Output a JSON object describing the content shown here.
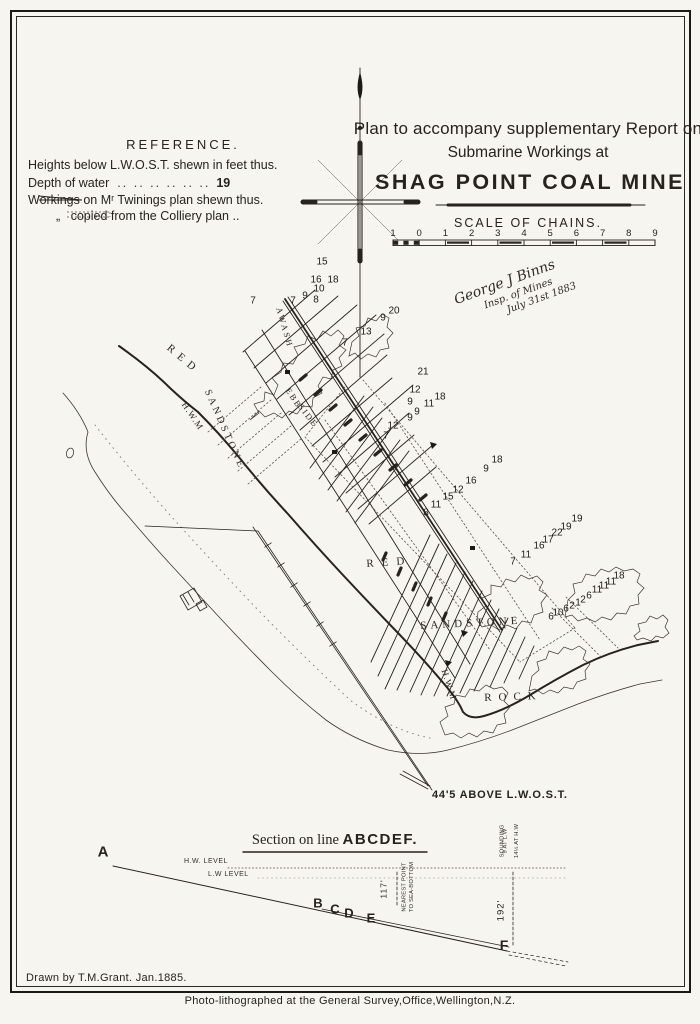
{
  "doc": {
    "title_line1": "Plan to accompany supplementary Report on",
    "title_line2": "Submarine Workings at",
    "title_line3": "SHAG POINT COAL MINE"
  },
  "reference": {
    "heading": "REFERENCE.",
    "rows": [
      {
        "prefix": "",
        "label": "Heights below L.W.O.S.T. shewn in feet thus.",
        "leader": "",
        "value": ""
      },
      {
        "prefix": "",
        "label": "Depth of water",
        "leader": "..  ..        ..   ..   ..   ..",
        "value": "19"
      },
      {
        "prefix": "",
        "label": "Workings on Mʳ Twinings plan shewn thus.",
        "leader": "",
        "value": ""
      },
      {
        "prefix": "„",
        "label": "copied from the Colliery plan ..",
        "leader": "",
        "value": ""
      }
    ]
  },
  "scale": {
    "heading": "SCALE OF CHAINS.",
    "ticks": [
      "1",
      "0",
      "1",
      "2",
      "3",
      "4",
      "5",
      "6",
      "7",
      "8",
      "9"
    ]
  },
  "signature": {
    "lines": [
      "George J Binns",
      "Insp. of Mines",
      "July 31st 1883"
    ]
  },
  "map": {
    "note_height": "44'5 ABOVE L.W.O.S.T.",
    "geology_labels": [
      {
        "t": "RED",
        "x": 172,
        "y": 342,
        "r": 40,
        "ls": 6,
        "fs": 11
      },
      {
        "t": "SANDSTONE",
        "x": 212,
        "y": 388,
        "r": 66,
        "ls": 3,
        "fs": 10
      },
      {
        "t": "H.W.M",
        "x": 188,
        "y": 400,
        "r": 56,
        "ls": 1,
        "fs": 9
      },
      {
        "t": "AWASH",
        "x": 284,
        "y": 306,
        "r": 74,
        "ls": 2.5,
        "fs": 8.5
      },
      {
        "t": "EBB",
        "x": 292,
        "y": 386,
        "r": 56,
        "ls": 2,
        "fs": 8.5
      },
      {
        "t": "SIDE",
        "x": 304,
        "y": 402,
        "r": 52,
        "ls": 2,
        "fs": 8.5
      },
      {
        "t": "RED",
        "x": 366,
        "y": 558,
        "r": -4,
        "ls": 8,
        "fs": 11
      },
      {
        "t": "SANDSTONE",
        "x": 420,
        "y": 620,
        "r": -3,
        "ls": 4,
        "fs": 11
      },
      {
        "t": "ROCK",
        "x": 484,
        "y": 692,
        "r": -2,
        "ls": 7,
        "fs": 11
      },
      {
        "t": "H.W.M",
        "x": 449,
        "y": 668,
        "r": 72,
        "ls": 1,
        "fs": 9
      }
    ],
    "depth_markers": [
      [
        322,
        262,
        "15"
      ],
      [
        316,
        280,
        "16"
      ],
      [
        333,
        280,
        "18"
      ],
      [
        319,
        289,
        "10"
      ],
      [
        305,
        296,
        "9"
      ],
      [
        316,
        300,
        "8"
      ],
      [
        253,
        301,
        "7"
      ],
      [
        293,
        301,
        "7"
      ],
      [
        383,
        318,
        "9"
      ],
      [
        394,
        311,
        "20"
      ],
      [
        366,
        332,
        "13"
      ],
      [
        345,
        343,
        "7"
      ],
      [
        423,
        372,
        "21"
      ],
      [
        415,
        390,
        "12"
      ],
      [
        410,
        402,
        "9"
      ],
      [
        429,
        404,
        "11"
      ],
      [
        440,
        397,
        "18"
      ],
      [
        417,
        412,
        "9"
      ],
      [
        410,
        418,
        "9"
      ],
      [
        393,
        426,
        "12"
      ],
      [
        386,
        436,
        "7"
      ],
      [
        497,
        460,
        "18"
      ],
      [
        486,
        469,
        "9"
      ],
      [
        471,
        481,
        "16"
      ],
      [
        458,
        490,
        "12"
      ],
      [
        448,
        497,
        "15"
      ],
      [
        436,
        505,
        "11"
      ],
      [
        426,
        513,
        "8"
      ],
      [
        577,
        519,
        "19"
      ],
      [
        566,
        527,
        "19"
      ],
      [
        557,
        533,
        "22"
      ],
      [
        548,
        540,
        "17"
      ],
      [
        539,
        546,
        "16"
      ],
      [
        526,
        555,
        "11"
      ],
      [
        513,
        562,
        "7"
      ],
      [
        619,
        576,
        "18"
      ],
      [
        611,
        582,
        "11"
      ],
      [
        604,
        586,
        "11"
      ],
      [
        597,
        590,
        "11"
      ],
      [
        589,
        596,
        "6"
      ],
      [
        583,
        600,
        "2"
      ],
      [
        578,
        603,
        "1"
      ],
      [
        572,
        606,
        "2"
      ],
      [
        566,
        609,
        "6"
      ],
      [
        558,
        613,
        "10"
      ],
      [
        551,
        617,
        "6"
      ]
    ]
  },
  "section": {
    "title_prefix": "Section on line ",
    "title_bold": "ABCDEF.",
    "level_hw": "H.W. LEVEL",
    "level_lw": "L.W LEVEL",
    "dim_nearest": "117'",
    "dim_nearest_note1": "NEAREST POINT",
    "dim_nearest_note2": "TO SEA-BOTTOM",
    "dim_depth": "192'",
    "sounding_l1": "SOUNDING",
    "sounding_l2": "9 AT L.W",
    "sounding_l3": "14½ AT H.W",
    "points": [
      {
        "l": "A",
        "x": 103,
        "y": 852,
        "fs": 15
      },
      {
        "l": "B",
        "x": 318,
        "y": 903,
        "fs": 13
      },
      {
        "l": "C",
        "x": 335,
        "y": 909,
        "fs": 13
      },
      {
        "l": "D",
        "x": 349,
        "y": 913,
        "fs": 13
      },
      {
        "l": "E",
        "x": 371,
        "y": 918,
        "fs": 13
      },
      {
        "l": "F",
        "x": 504,
        "y": 945,
        "fs": 14
      }
    ]
  },
  "credits": {
    "drawn_by": "Drawn by T.M.Grant. Jan.1885.",
    "litho": "Photo-lithographed at the General Survey,Office,Wellington,N.Z."
  }
}
